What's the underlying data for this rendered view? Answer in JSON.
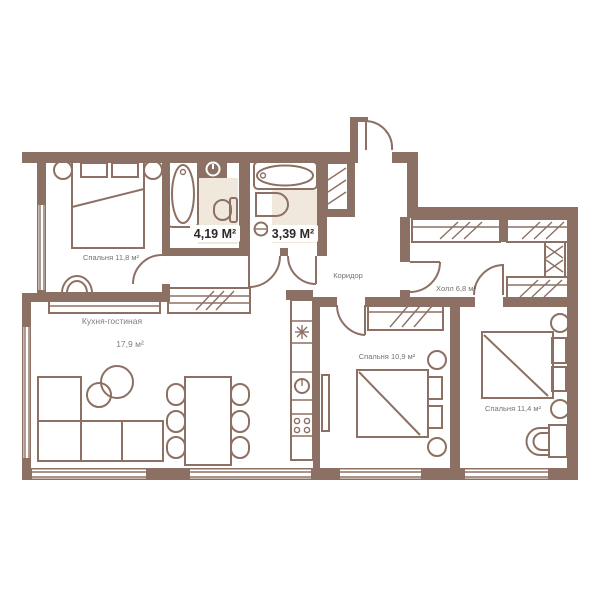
{
  "plan": {
    "type": "apartment-floor-plan",
    "labels": {
      "bath1_area": "4,19 М²",
      "bath2_area": "3,39 М²",
      "bedroom1": "Спальня 11,8 м²",
      "living_line1": "Кухня-гостиная",
      "living_line2": "17,9 м²",
      "corridor": "Коридор",
      "hall": "Холл 6,8 м²",
      "bedroom2": "Спальня 10,9 м²",
      "bedroom3": "Спальня 11,4 м²"
    },
    "colors": {
      "wall": "#8C7063",
      "tile_floor": "#F0E8DD",
      "label_text": "#2E2926",
      "label_background": "#FFFFFF",
      "background": "#FFFFFF"
    },
    "icons": {
      "bathtub": "bathtub-icon",
      "washing_machine": "washing-machine-icon",
      "toilet": "toilet-icon",
      "sink": "sink-icon",
      "fridge": "snowflake-icon",
      "oven": "oven-dial-icon",
      "cooktop": "cooktop-burners-icon",
      "wardrobe": "wardrobe-hatch-icon",
      "shaft": "vent-shaft-hatch-icon",
      "door": "door-swing-arc"
    }
  }
}
